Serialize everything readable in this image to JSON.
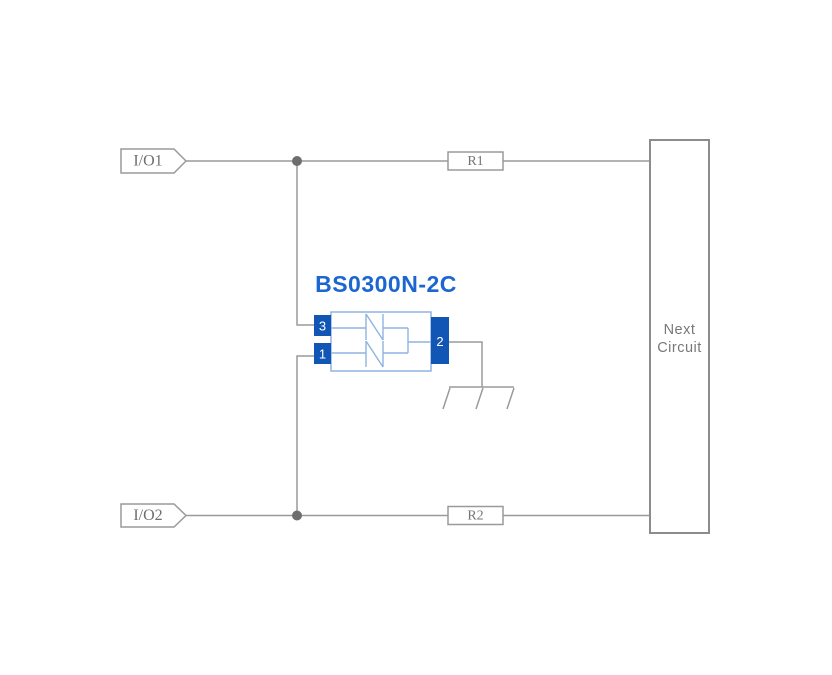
{
  "diagram": {
    "component": {
      "name": "BS0300N-2C",
      "pin_top_left": "3",
      "pin_bottom_left": "1",
      "pin_right": "2"
    },
    "ports": {
      "io1": "I/O1",
      "io2": "I/O2"
    },
    "resistors": {
      "r1": "R1",
      "r2": "R2"
    },
    "next_circuit": {
      "line1": "Next",
      "line2": "Circuit"
    },
    "colors": {
      "background": "#ffffff",
      "wire": "#9a9a9a",
      "junction_dot": "#6e6e6e",
      "label_gray": "#6f6f6f",
      "component_title_blue": "#1c66d0",
      "pin_fill_blue": "#1156b5",
      "body_outline_blue": "#8fb3e2"
    }
  }
}
